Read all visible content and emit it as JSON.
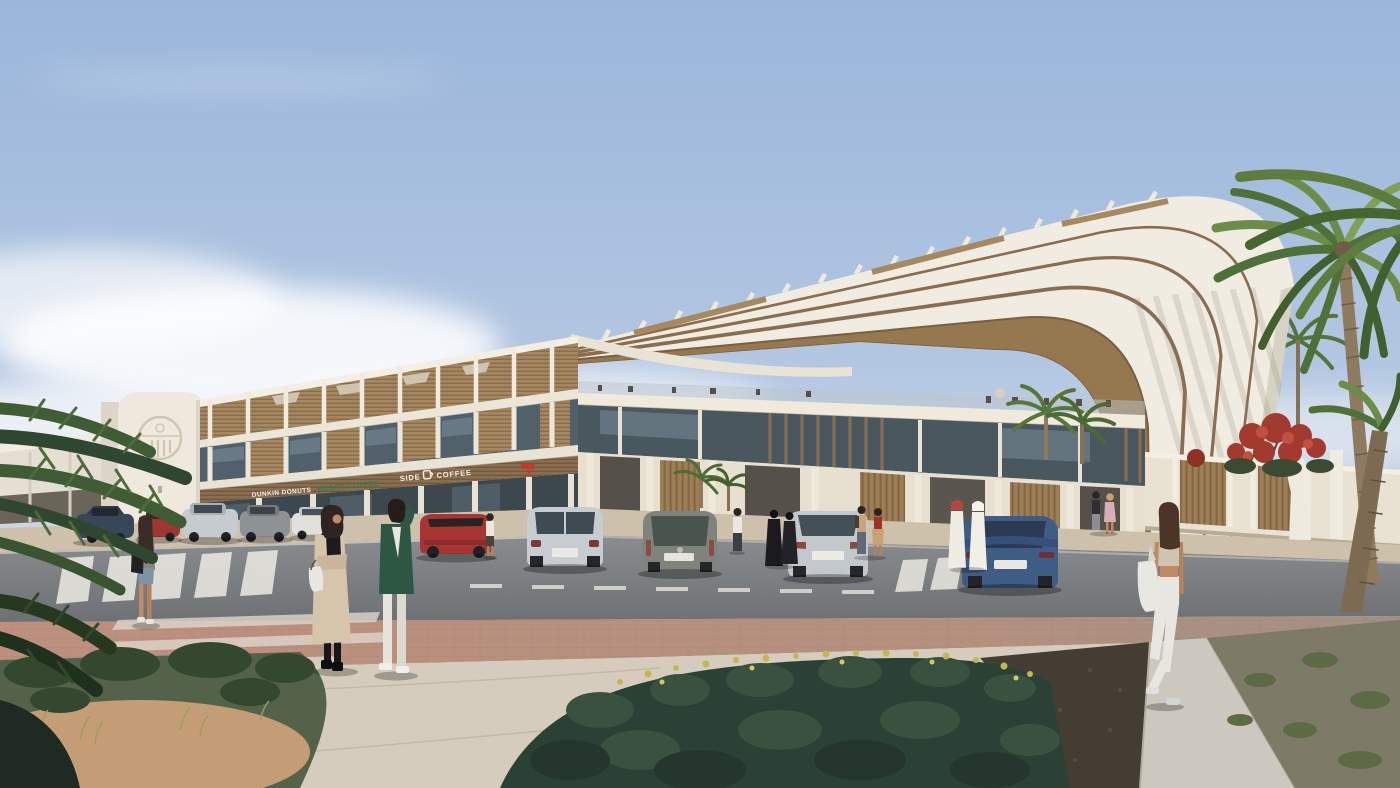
{
  "scene": {
    "type": "architectural-exterior-render",
    "description": "Daytime photorealistic rendering of a modern white commercial / retail complex with a giant sweeping arch canopy, rooftop terrace, timber louvres, palm trees, parked cars and pedestrians",
    "time_of_day": "late afternoon sun from the right"
  },
  "signage": {
    "store_1": "DUNKIN DONUTS",
    "store_2": "HEART COFFEE",
    "store_3_left": "SIDE",
    "store_3_right": "COFFEE",
    "red_logo_sign": "small red cafe logo (illegible)",
    "emblem": "embossed circular emblem on entrance pylon"
  },
  "colors": {
    "sky_top": "#9ab6db",
    "sky_horizon": "#e9edf2",
    "cloud": "#f7f8fa",
    "building_white": "#f1ece1",
    "building_shade": "#d9d3c5",
    "wood_louvre": "#a5885f",
    "wood_dark": "#8a6d4e",
    "glass": "#49575f",
    "road_asphalt": "#7b7e82",
    "paver_pink": "#bd8f7e",
    "concrete_path": "#d6ccbe",
    "shrub_dark_green": "#2c4136",
    "palm_green": "#6a8a45",
    "flower_red": "#b23b30",
    "flower_yellow": "#c3b754",
    "sand": "#c49d77",
    "sign_green": "#2f7d4f",
    "sign_red": "#c0392b"
  },
  "entities": {
    "people": [
      "woman with shoulder bag walking at left crosswalk",
      "woman in long beige coat with white handbag (center pair)",
      "man in green jacket and white trousers (center pair)",
      "pedestrian near left storefronts",
      "man walking by colonnade",
      "two women in black abayas",
      "man with backpack talking to woman in red top",
      "two men in white thobes with headdress",
      "man in dark jacket and woman in pink dress near right entrance",
      "woman in white jeans with white tote walking away on right path"
    ],
    "vehicles": [
      "dark blue sedan (far left row)",
      "red sedan (far left row)",
      "silver SUV (far left row)",
      "grey SUV (far left row)",
      "white sedan (far left row)",
      "red convertible",
      "silver luxury SUV (rear view)",
      "grey hatchback (rear view)",
      "silver sedan (rear view)",
      "dark blue coupe (rear view)"
    ],
    "vegetation": [
      "dark palm fronds overhanging the left foreground",
      "foreground bed of dark shrubs with yellow flowering hedge",
      "date palms beside and behind the arch",
      "red bougainvillea over the perimeter wall",
      "ornamental grasses on right verge"
    ],
    "architecture": [
      "entrance pylon with circular emblem",
      "two-storey retail wing with timber louvre screens and rooftop pergola terrace",
      "glass atrium block with timber fins",
      "giant layered arch canopy with roof louvres",
      "perimeter wall with timber slat gates",
      "white draped sculpture near right wall"
    ]
  }
}
